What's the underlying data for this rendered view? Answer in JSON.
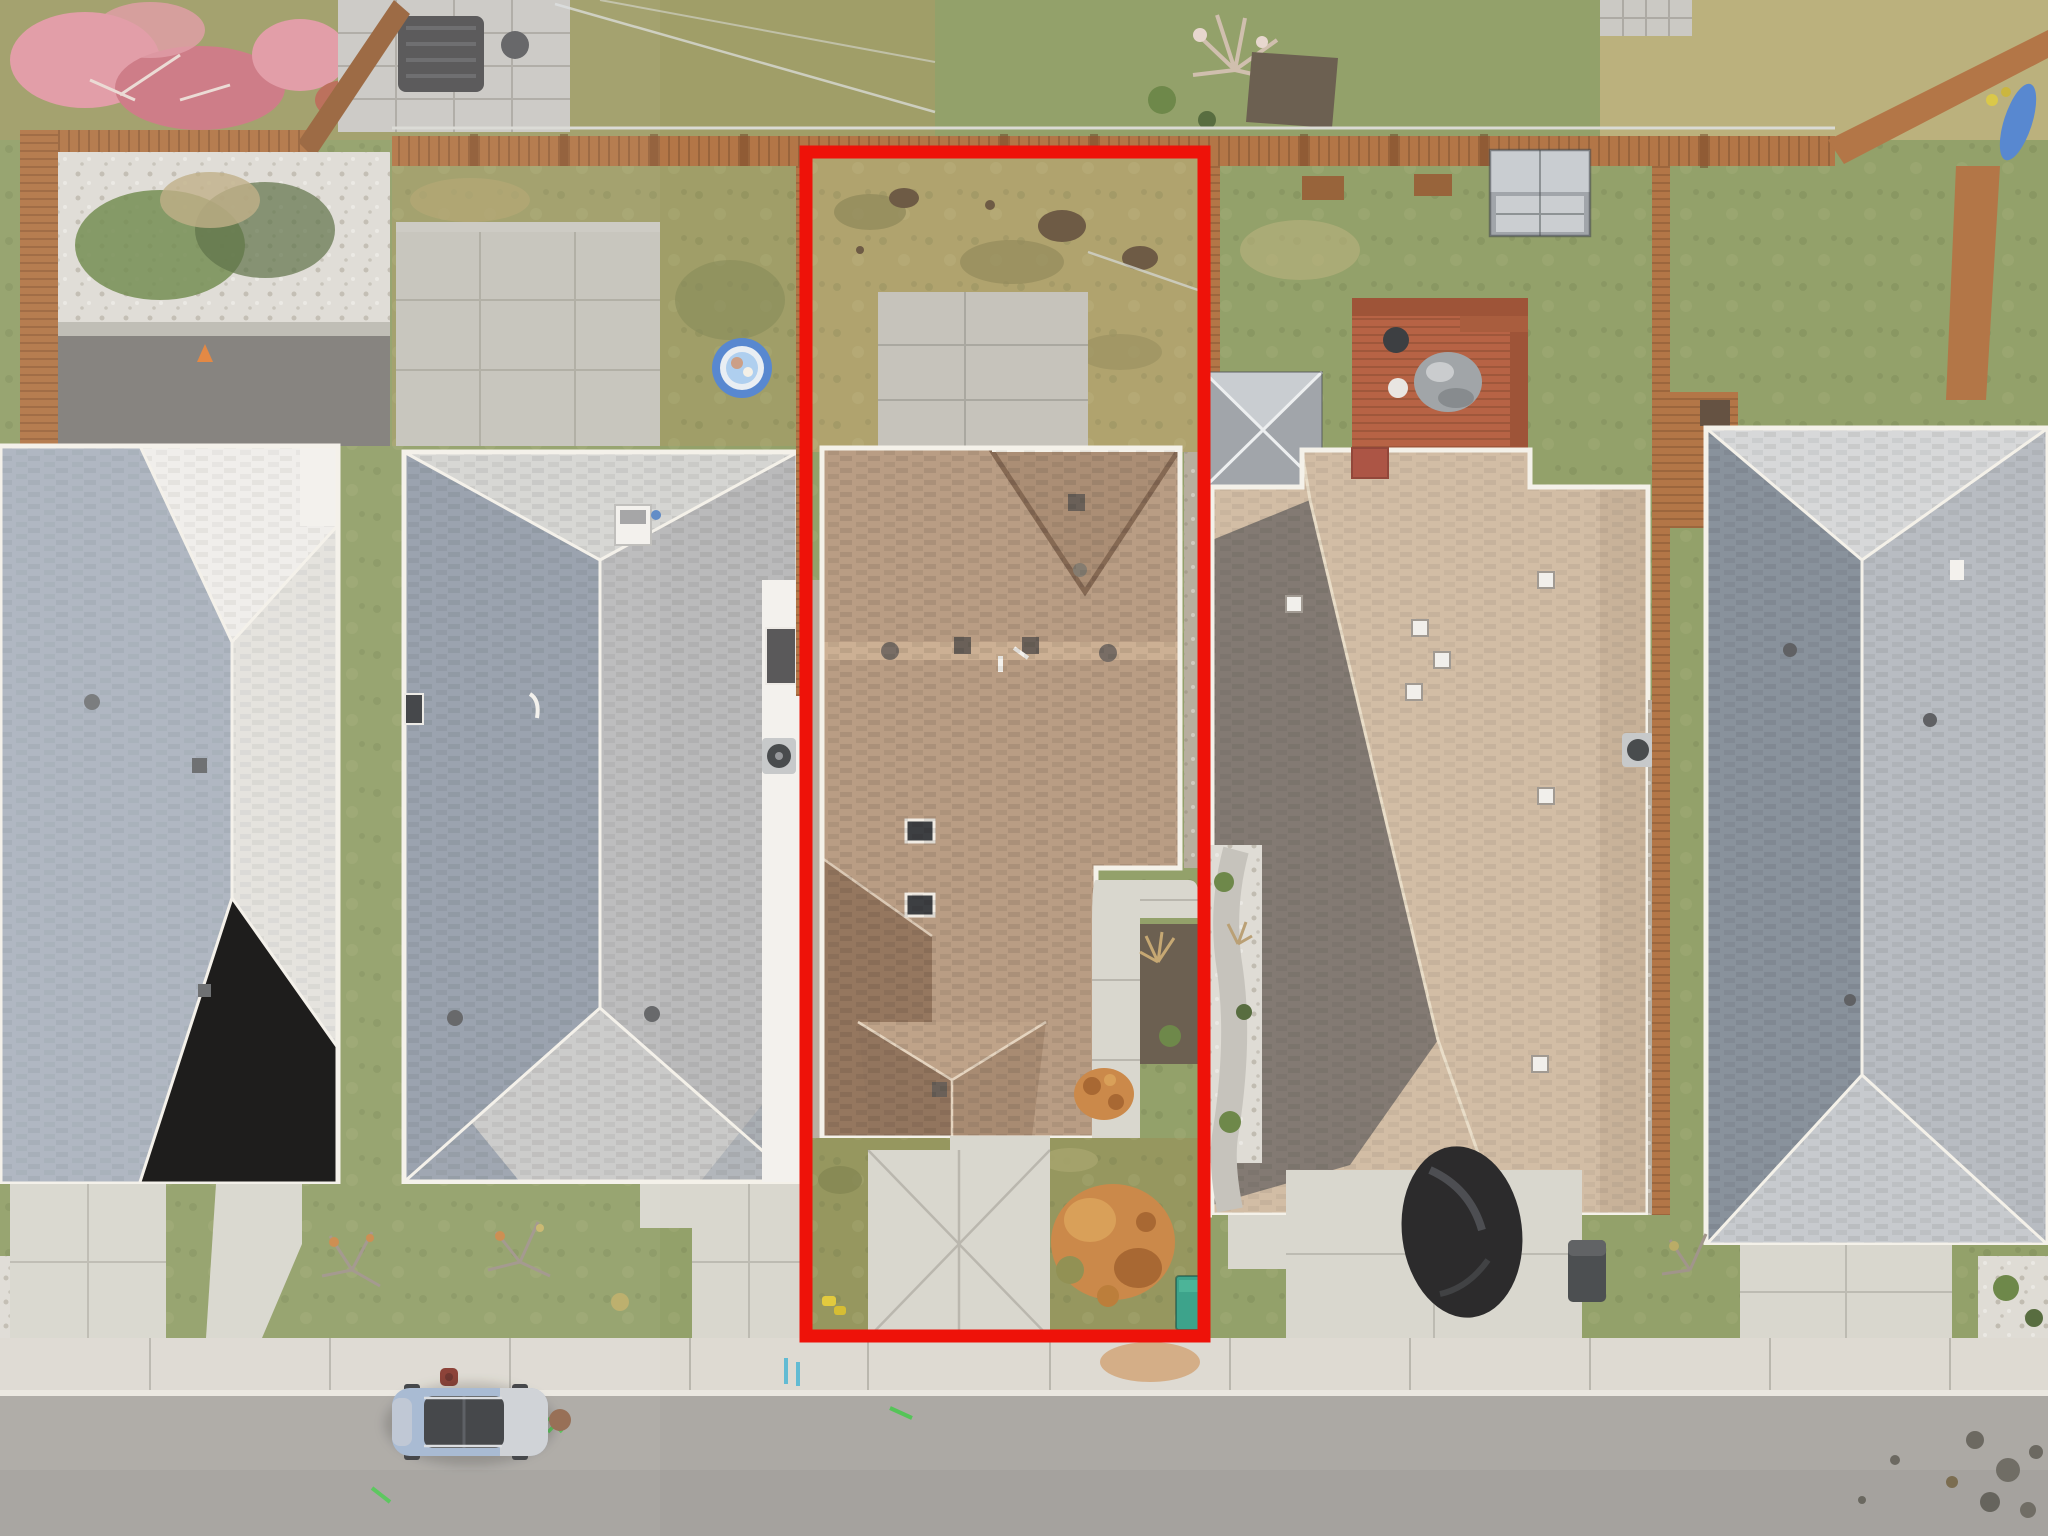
{
  "scene": {
    "type": "real-estate-aerial-photo",
    "description": "Top-down drone photograph of a suburban street; the middle lot (house with brown shingle roof, backyard, driveway) is outlined with a bright red property-boundary rectangle. Neighboring lots have gray, white, tan and blue-gray roofs, wooden fences, a red deck with shed and gazebo, a kiddie pool, and a blue SUV parked on the street."
  },
  "annotation": {
    "kind": "property-boundary",
    "shape": "rectangle",
    "boundary_color": "#ee1209",
    "boundary_stroke_px": 13
  },
  "objects": {
    "subject_lot": "center lot with brown roof house",
    "vehicle": "blue SUV parked on street",
    "utility_box": "green utility pedestal at lot corner",
    "pool": "blue kiddie pool in left neighbor backyard",
    "shed": "gray metal shed in right neighbor backyard",
    "deck": "red wooden deck with covered BBQ",
    "hydrant": "red fire hydrant on sidewalk"
  },
  "colors": {
    "street": "#a6a4a0",
    "sidewalk": "#dcd9d1",
    "concrete": "#d7d5cd",
    "concreteShadow": "#c2c0b8",
    "asphaltDark": "#787673",
    "grassGreen": "#8b9b61",
    "grassOlive": "#99985f",
    "grassDry": "#ab9e66",
    "grassPale": "#b6ad76",
    "dirt": "#63503a",
    "mulch": "#615646",
    "fenceWood": "#ae6d3c",
    "fenceDark": "#915a2f",
    "railLight": "#d9dad2",
    "deckRed": "#b2593a",
    "deckDark": "#97492c",
    "roofBrown": "#b4977d",
    "roofBrownDark": "#8d6e55",
    "roofBrownMid": "#a5876d",
    "roofBrownRidge": "#c9ac8e",
    "roofGray": "#b5b6b8",
    "roofGrayDark": "#8e99a7",
    "roofGrayLight": "#d2d3d1",
    "roofWhite": "#e8e7e4",
    "roofWhiteShadow": "#a6b0bd",
    "roofTan": "#cfbaa1",
    "roofTanDark": "#7a726b",
    "roofBlue": "#b3b9c0",
    "roofBlueDark": "#808b97",
    "roofBlueLight": "#d4d7d9",
    "gutter": "#f4f1ea",
    "pinkTree": "#df93a0",
    "pinkTreeDeep": "#c96e7b",
    "orangeBush": "#c8823f",
    "orangeDeep": "#a25e26",
    "shedGray": "#9aa0a6",
    "shedLight": "#c5cbd0",
    "poolBlue": "#4c80cf",
    "poolLight": "#a9cdf0",
    "carBlue": "#9fb4d0",
    "carSilver": "#cbcfd4",
    "glassDark": "#2f3236",
    "utilityGreen": "#2f9e85",
    "rockWhite": "#dddbd4",
    "shrubGreen": "#64803f",
    "shrubDark": "#4c6334",
    "coneOrange": "#e07b2f",
    "hydrantRed": "#7e2c22",
    "paintGreen": "#49c14e",
    "paintBlue": "#57b7d2",
    "white": "#f3f2ee",
    "stoneGray": "#c7c6c2",
    "treeBranch": "#cdbcab"
  }
}
